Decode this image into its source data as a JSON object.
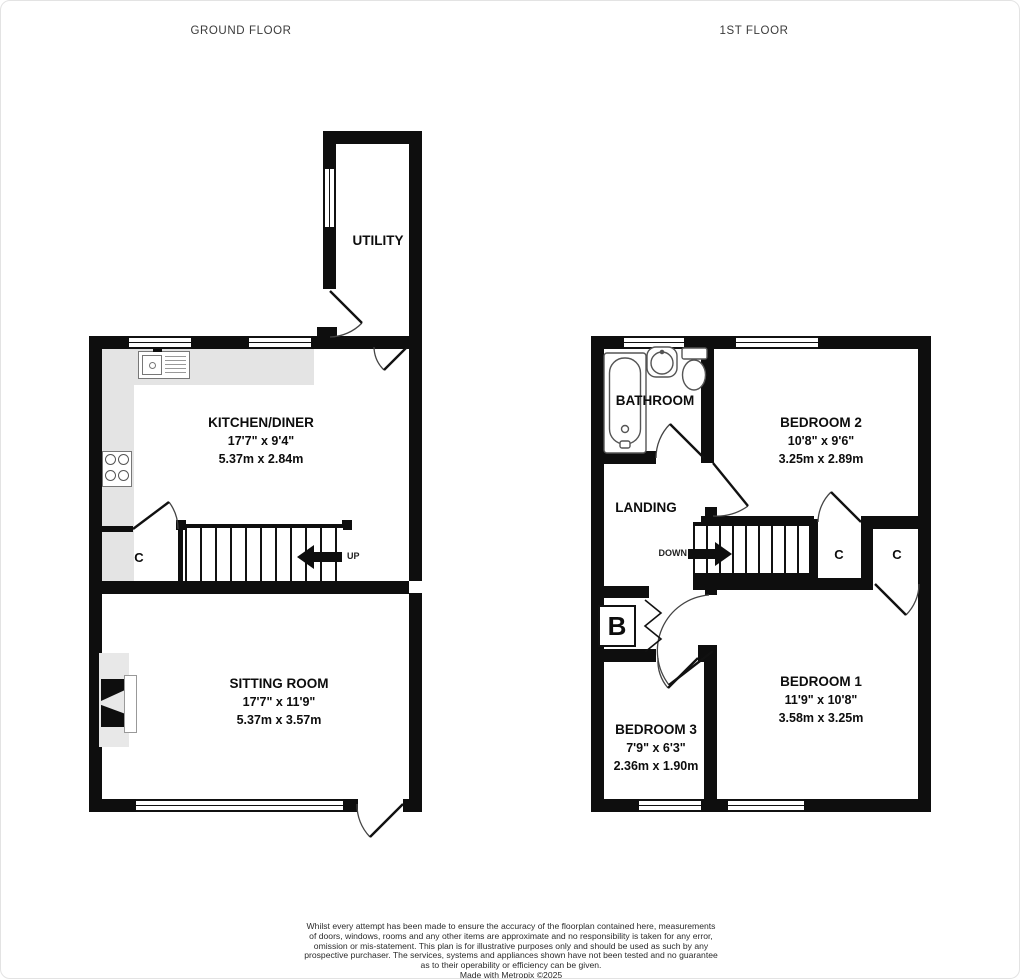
{
  "headers": {
    "ground": "GROUND FLOOR",
    "first": "1ST FLOOR"
  },
  "ground": {
    "rooms": [
      {
        "name": "UTILITY"
      },
      {
        "name": "KITCHEN/DINER",
        "imperial": "17'7\" x 9'4\"",
        "metric": "5.37m x 2.84m"
      },
      {
        "name": "SITTING ROOM",
        "imperial": "17'7\" x 11'9\"",
        "metric": "5.37m x 3.57m"
      }
    ],
    "labels": {
      "cupboard": "C",
      "up": "UP"
    }
  },
  "first": {
    "rooms": [
      {
        "name": "BATHROOM"
      },
      {
        "name": "BEDROOM 2",
        "imperial": "10'8\" x 9'6\"",
        "metric": "3.25m x 2.89m"
      },
      {
        "name": "LANDING"
      },
      {
        "name": "BEDROOM 1",
        "imperial": "11'9\" x 10'8\"",
        "metric": "3.58m x 3.25m"
      },
      {
        "name": "BEDROOM 3",
        "imperial": "7'9\" x 6'3\"",
        "metric": "2.36m x 1.90m"
      }
    ],
    "labels": {
      "down": "DOWN",
      "cupboard1": "C",
      "cupboard2": "C",
      "boiler": "B"
    }
  },
  "colors": {
    "wall": "#0e0e0e",
    "counter": "#e4e4e4",
    "hearth": "#e8e8e8"
  },
  "footer": {
    "disclaimer_lines": [
      "Whilst every attempt has been made to ensure the accuracy of the floorplan contained here, measurements",
      "of doors, windows, rooms and any other items are approximate and no responsibility is taken for any error,",
      "omission or mis-statement. This plan is for illustrative purposes only and should be used as such by any",
      "prospective purchaser. The services, systems and appliances shown have not been tested and no guarantee",
      "as to their operability or efficiency can be given."
    ],
    "credit": "Made with Metropix ©2025"
  }
}
